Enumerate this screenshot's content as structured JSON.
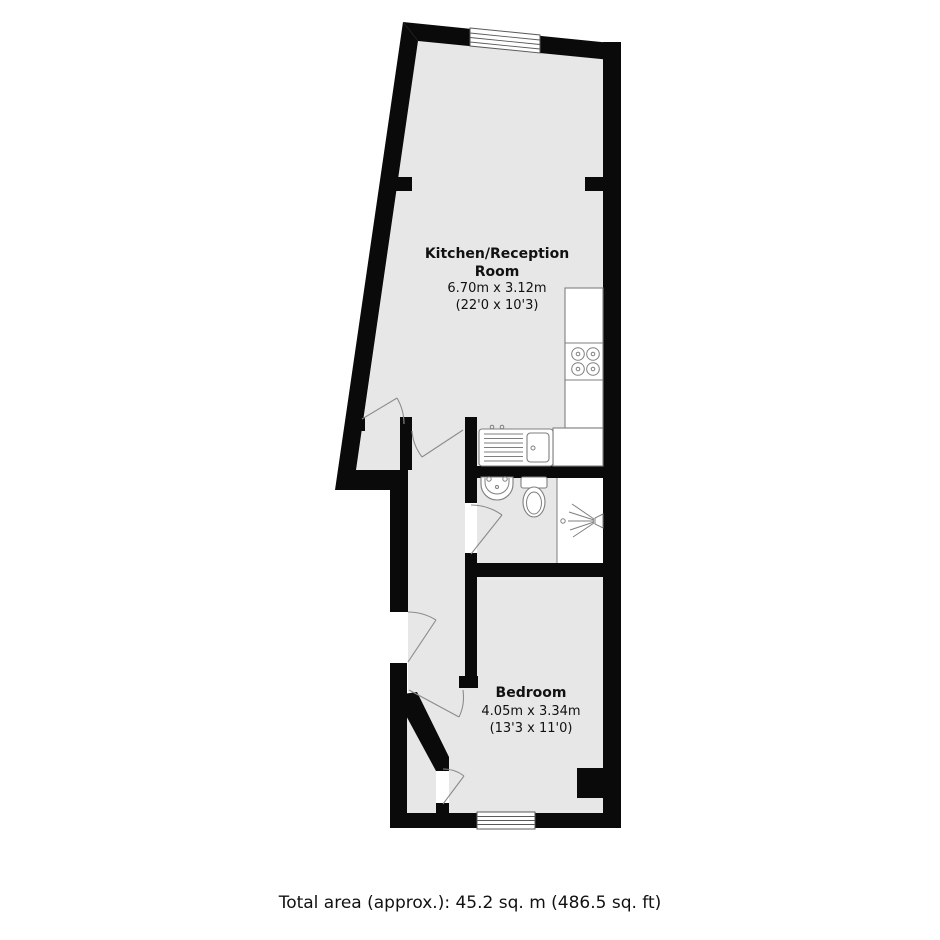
{
  "floorplan": {
    "rooms": [
      {
        "id": "kitchen-reception",
        "label_line1": "Kitchen/Reception",
        "label_line2": "Room",
        "size_metric": "6.70m x 3.12m",
        "size_imperial": "(22'0 x 10'3)"
      },
      {
        "id": "bedroom",
        "label_line1": "Bedroom",
        "size_metric": "4.05m x 3.34m",
        "size_imperial": "(13'3 x 11'0)"
      }
    ],
    "fixtures": [
      "hob",
      "kitchen-sink",
      "wash-basin",
      "toilet",
      "shower"
    ],
    "windows": 2,
    "doors": 6,
    "total_area_label": "Total area (approx.): 45.2 sq. m (486.5 sq. ft)",
    "colors": {
      "wall": "#0a0a0a",
      "floor": "#e7e7e7",
      "fixture_stroke": "#7f7f7f",
      "door_arc": "#8c8c8c",
      "text": "#111111",
      "background": "#ffffff"
    }
  }
}
